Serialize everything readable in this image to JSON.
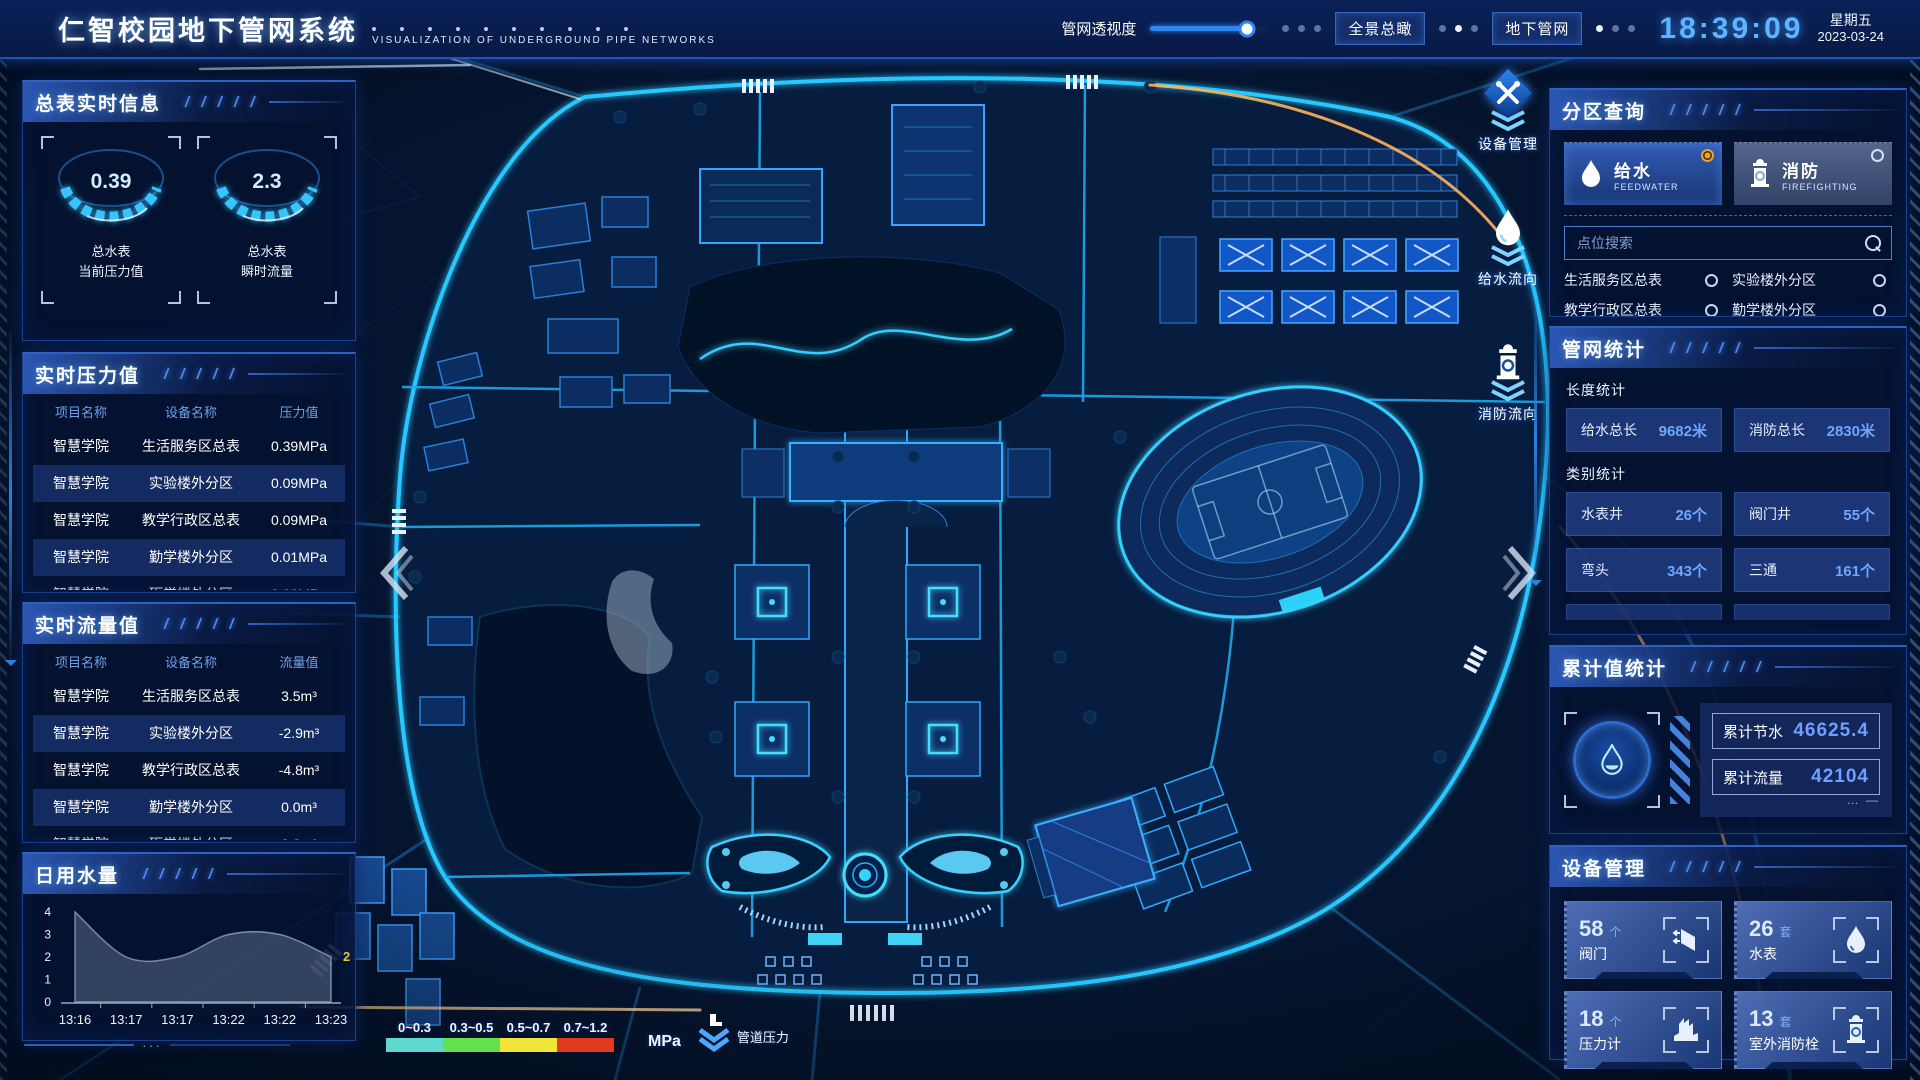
{
  "ui": {
    "slashes": "/ / / / /"
  },
  "header": {
    "title": "仁智校园地下管网系统",
    "subtitle": "VISUALIZATION OF UNDERGROUND PIPE NETWORKS",
    "transparency_label": "管网透视度",
    "transparency_percent": 82,
    "buttons": [
      {
        "label": "全景总瞰"
      },
      {
        "label": "地下管网"
      }
    ],
    "clock": {
      "time": "18:39:09",
      "weekday": "星期五",
      "date": "2023-03-24"
    }
  },
  "left": {
    "meter_info": {
      "title": "总表实时信息",
      "gauges": [
        {
          "value": "0.39",
          "label_line1": "总水表",
          "label_line2": "当前压力值"
        },
        {
          "value": "2.3",
          "label_line1": "总水表",
          "label_line2": "瞬时流量"
        }
      ]
    },
    "pressure": {
      "title": "实时压力值",
      "columns": [
        "项目名称",
        "设备名称",
        "压力值"
      ],
      "rows": [
        [
          "智慧学院",
          "生活服务区总表",
          "0.39MPa"
        ],
        [
          "智慧学院",
          "实验楼外分区",
          "0.09MPa"
        ],
        [
          "智慧学院",
          "教学行政区总表",
          "0.09MPa"
        ],
        [
          "智慧学院",
          "勤学楼外分区",
          "0.01MPa"
        ],
        [
          "智慧学院",
          "砺学楼外分区",
          "0.00MPa"
        ]
      ]
    },
    "flow": {
      "title": "实时流量值",
      "columns": [
        "项目名称",
        "设备名称",
        "流量值"
      ],
      "rows": [
        [
          "智慧学院",
          "生活服务区总表",
          "3.5m³"
        ],
        [
          "智慧学院",
          "实验楼外分区",
          "-2.9m³"
        ],
        [
          "智慧学院",
          "教学行政区总表",
          "-4.8m³"
        ],
        [
          "智慧学院",
          "勤学楼外分区",
          "0.0m³"
        ],
        [
          "智慧学院",
          "砺学楼外分区",
          "2.3m³"
        ]
      ]
    },
    "daily_water": {
      "title": "日用水量"
    }
  },
  "chart_data": {
    "type": "area",
    "title": "日用水量",
    "x": [
      "13:16",
      "13:17",
      "13:17",
      "13:22",
      "13:22",
      "13:23"
    ],
    "values": [
      4,
      2,
      2,
      3,
      3,
      2
    ],
    "ylim": [
      0,
      4
    ],
    "yticks": [
      0,
      1,
      2,
      3,
      4
    ],
    "end_label": "2",
    "end_label_color": "#e8c33a",
    "area_color": "rgba(150,170,205,0.32)",
    "grid": false,
    "legend_position": "none"
  },
  "map": {
    "controls": [
      {
        "label": "设备管理",
        "icon": "tools-icon"
      },
      {
        "label": "给水流向",
        "icon": "waterdrop-icon"
      },
      {
        "label": "消防流向",
        "icon": "hydrant-icon"
      }
    ],
    "legend": {
      "ranges": [
        {
          "label": "0~0.3",
          "color": "#5fd8d0"
        },
        {
          "label": "0.3~0.5",
          "color": "#63e04e"
        },
        {
          "label": "0.5~0.7",
          "color": "#f2e53a"
        },
        {
          "label": "0.7~1.2",
          "color": "#e23a1f"
        }
      ],
      "unit": "MPa",
      "note": "管道压力"
    }
  },
  "right": {
    "zone_query": {
      "title": "分区查询",
      "systems": [
        {
          "name": "给水",
          "en": "FEEDWATER",
          "selected": true
        },
        {
          "name": "消防",
          "en": "FIREFIGHTING",
          "selected": false
        }
      ],
      "search_placeholder": "点位搜索",
      "points": [
        "生活服务区总表",
        "实验楼外分区",
        "教学行政区总表",
        "勤学楼外分区",
        "砺学楼外分区",
        "宿舍区泵房"
      ]
    },
    "network_stats": {
      "title": "管网统计",
      "length_label": "长度统计",
      "length_stats": [
        {
          "name": "给水总长",
          "value": "9682米"
        },
        {
          "name": "消防总长",
          "value": "2830米"
        }
      ],
      "category_label": "类别统计",
      "category_stats": [
        {
          "name": "水表井",
          "value": "26个"
        },
        {
          "name": "阀门井",
          "value": "55个"
        },
        {
          "name": "弯头",
          "value": "343个"
        },
        {
          "name": "三通",
          "value": "161个"
        }
      ]
    },
    "cumulative": {
      "title": "累计值统计",
      "items": [
        {
          "name": "累计节水",
          "value": "46625.4"
        },
        {
          "name": "累计流量",
          "value": "42104"
        }
      ]
    },
    "devices": {
      "title": "设备管理",
      "items": [
        {
          "count": "58",
          "unit": "个",
          "name": "阀门",
          "icon": "valve-icon"
        },
        {
          "count": "26",
          "unit": "套",
          "name": "水表",
          "icon": "watermeter-icon"
        },
        {
          "count": "18",
          "unit": "个",
          "name": "压力计",
          "icon": "pressure-gauge-icon"
        },
        {
          "count": "13",
          "unit": "套",
          "name": "室外消防栓",
          "icon": "hydrant-icon"
        }
      ]
    }
  }
}
